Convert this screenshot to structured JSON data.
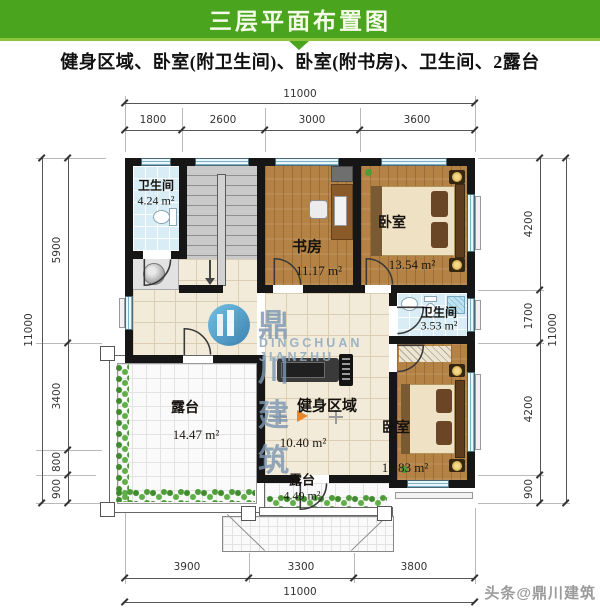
{
  "header": {
    "title": "三层平面布置图",
    "subtitle": "健身区域、卧室(附卫生间)、卧室(附书房)、卫生间、2露台"
  },
  "dims": {
    "top_total": "11000",
    "top_segments": [
      "1800",
      "2600",
      "3000",
      "3600"
    ],
    "bottom_total": "11000",
    "bottom_segments": [
      "3900",
      "3300",
      "3800"
    ],
    "left_total": "11000",
    "left_segments": [
      "5900",
      "3400",
      "800",
      "900"
    ],
    "right_total": "11000",
    "right_segments": [
      "4200",
      "1700",
      "4200",
      "900"
    ]
  },
  "rooms": {
    "bath1": {
      "name": "卫生间",
      "area": "4.24 m²"
    },
    "study": {
      "name": "书房",
      "area": "11.17 m²"
    },
    "bed1": {
      "name": "卧室",
      "area": "13.54 m²"
    },
    "bath2": {
      "name": "卫生间",
      "area": "3.53 m²"
    },
    "gym": {
      "name": "健身区域",
      "area": "10.40 m²"
    },
    "terrace1": {
      "name": "露台",
      "area": "14.47 m²"
    },
    "bed2": {
      "name": "卧室",
      "area": "15.83 m²"
    },
    "terrace2": {
      "name": "露台",
      "area": "4.49 m²"
    }
  },
  "watermark": {
    "cn": "鼎川建筑",
    "en": "DINGCHUAN JIANZHU"
  },
  "footer": {
    "credit": "头条@鼎川建筑"
  },
  "colors": {
    "accent_green": "#4ba41e",
    "wall_black": "#161616",
    "wood_floor": "#b48245",
    "bath_blue": "#d9edf6",
    "logo_blue": "#3f9ed2",
    "plant_green": "#4e9c37"
  }
}
